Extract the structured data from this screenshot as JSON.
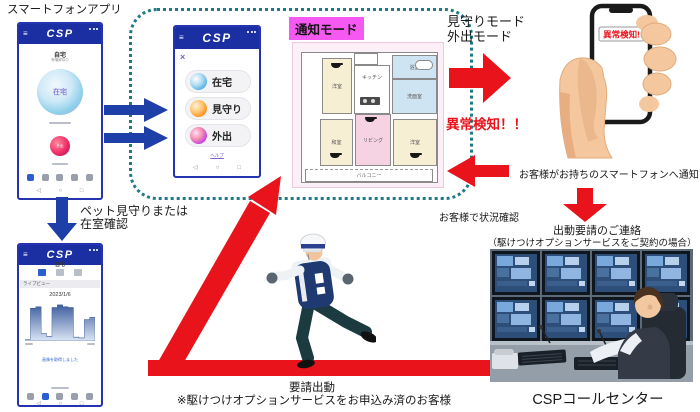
{
  "page": {
    "app_label": "スマートフォンアプリ",
    "pet_line1": "ペット見守りまたは",
    "pet_line2": "在室確認",
    "mode_line1": "見守りモード",
    "mode_line2": "外出モード",
    "alert": "異常検知！！",
    "phone_alert": "異常検知!",
    "notify": "お客様がお持ちのスマートフォンへ通知",
    "check": "お客様で状況確認",
    "request_line1": "出動要請のご連絡",
    "request_line2": "（駆けつけオプションサービスをご契約の場合）",
    "call_center": "CSPコールセンター",
    "dispatch_line1": "要請出動",
    "dispatch_line2": "※駆けつけオプションサービスをお申込み済のお客様",
    "notify_badge": "通知モード"
  },
  "phone_home": {
    "brand": "CSP",
    "title": "自宅",
    "subtitle": "警備解除中",
    "main_mode": "在宅",
    "quick_mode": "外出"
  },
  "phone_mode": {
    "brand": "CSP",
    "close": "×",
    "modes": [
      {
        "label": "在宅"
      },
      {
        "label": "見守り"
      },
      {
        "label": "外出"
      }
    ],
    "link": "ヘルプ"
  },
  "phone_live": {
    "brand": "CSP",
    "title": "自宅",
    "tab_label": "ライブビュー",
    "date": "2023/1/6",
    "message": "画像を取得しました",
    "chart": {
      "type": "area",
      "values": [
        4,
        86,
        90,
        20,
        12,
        88,
        95,
        90,
        88,
        10,
        8,
        56,
        62,
        58
      ]
    }
  },
  "floorplan": {
    "rooms": {
      "bedroom1": "洋室",
      "kitchen": "キッチン",
      "bath": "浴室",
      "washroom": "洗面室",
      "tatami": "和室",
      "living": "リビング",
      "bedroom2": "洋室",
      "balcony": "バルコニー"
    }
  },
  "icons": {
    "hamburger": "≡",
    "back": "◁",
    "home": "○",
    "recent": "□"
  },
  "colors": {
    "accent_blue": "#1e3fa8",
    "alert_red": "#e8131b",
    "dash_teal": "#1d7a86",
    "badge_magenta": "#f659f2",
    "header_blue": "#1b2fa3"
  }
}
